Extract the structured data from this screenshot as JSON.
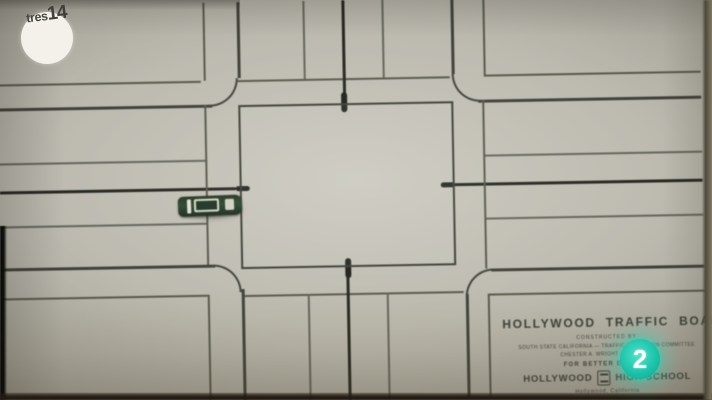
{
  "tv_overlay": {
    "tres14_logo": {
      "prefix": "tres",
      "suffix": "14"
    },
    "channel_bug": {
      "digit": "2",
      "color": "#1cc7ae"
    }
  },
  "board": {
    "colors": {
      "surface": "#bcbaaf",
      "road_line": "#4b4c44",
      "center_line": "#23261f"
    },
    "panel": {
      "title": "HOLLYWOOD TRAFFIC BOARD",
      "subtitle": "CONSTRUCTED BY",
      "credit_line_1": "SOUTH STATE CALIFORNIA  —  TRAFFIC EDUCATION COMMITTEE",
      "credit_line_2": "CHESTER A. WRIGHT  ·  DIRECTOR",
      "motto": "FOR BETTER DRIVING",
      "school_name_left": "HOLLYWOOD",
      "school_name_right": "HIGH SCHOOL",
      "location": "Hollywood, California"
    },
    "car": {
      "body_color": "#22371f",
      "trim_color": "#d6d8c6"
    }
  }
}
